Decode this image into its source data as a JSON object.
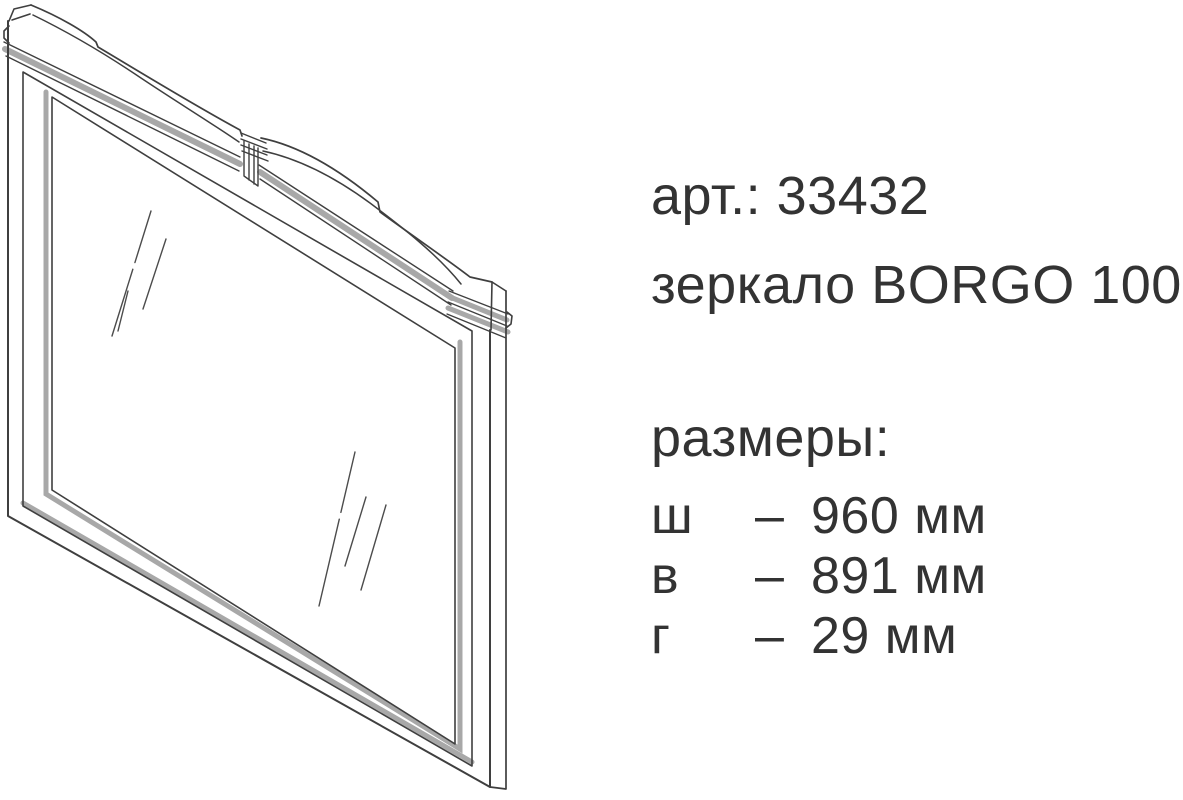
{
  "page": {
    "background_color": "#ffffff",
    "text_color": "#333333",
    "line_color": "#3f3f3f",
    "shade_color": "#a8a8a8"
  },
  "product": {
    "article": "арт.: 33432",
    "title": "зеркало BORGO 100",
    "dimensions_heading": "размеры:",
    "dimensions": [
      {
        "label": "ш",
        "separator": "–",
        "value": "960 мм"
      },
      {
        "label": "в",
        "separator": "–",
        "value": "891 мм"
      },
      {
        "label": "г",
        "separator": "–",
        "value": "29 мм"
      }
    ]
  },
  "drawing": {
    "type": "technical-line-drawing",
    "subject": "mirror with curved crest, three-quarter view"
  }
}
